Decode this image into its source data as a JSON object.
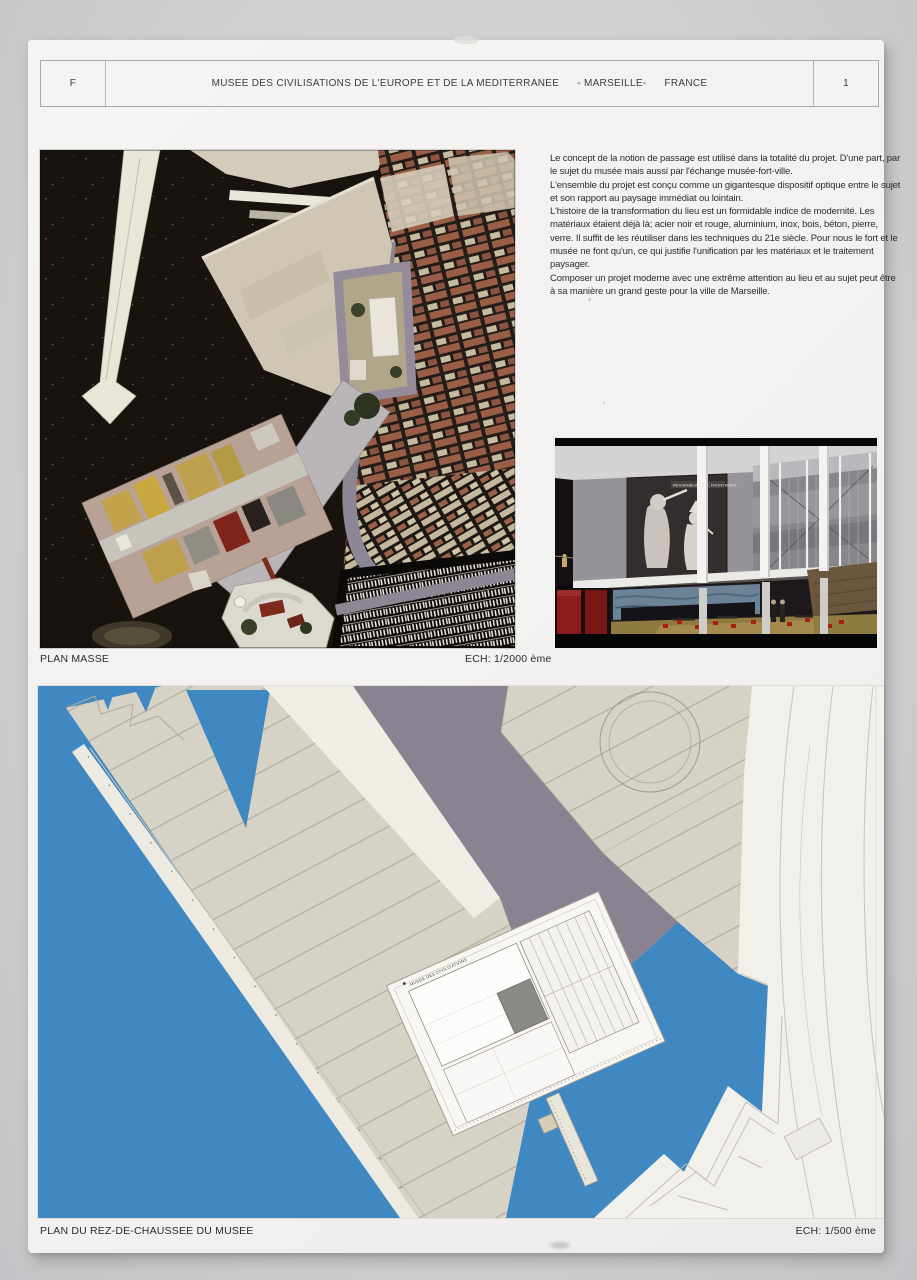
{
  "header": {
    "country_code": "F",
    "title_main": "MUSEE DES CIVILISATIONS DE L'EUROPE ET DE LA MEDITERRANEE",
    "title_city": "- MARSEILLE-",
    "title_country": "FRANCE",
    "page_number": "1"
  },
  "intro_text": {
    "paragraphs": [
      "Le concept de la notion de passage est utilisé dans la totalité du projet. D'une part, par le sujet du musée mais aussi par l'échange musée-fort-ville.",
      "L'ensemble du projet est conçu comme un gigantesque dispositif optique entre le sujet et son rapport au paysage immédiat ou lointain.",
      "L'histoire de la transformation du lieu est un formidable indice de modernité. Les matériaux étaient déjà là; acier noir et rouge, aluminium, inox, bois, béton, pierre, verre. Il suffit de les réutiliser dans les techniques du 21e siècle. Pour nous le fort et le musée ne font qu'un, ce qui justifie l'unification par les matériaux et le traitement paysager.",
      "Composer un projet moderne avec une extrême attention au lieu et au sujet peut être à sa manière un grand geste pour la ville de Marseille."
    ]
  },
  "figures": {
    "plan_masse": {
      "label": "PLAN MASSE",
      "scale": "ECH: 1/2000 ème"
    },
    "ground_floor": {
      "label": "PLAN DU REZ-DE-CHAUSSEE DU MUSEE",
      "scale": "ECH: 1/500 ème"
    },
    "interior_render": {
      "mural_caption": "RESSEMBLANCES, FRONTIERES"
    },
    "site_plan": {
      "building_label": "MUSEE DES CIVILISATIONS"
    }
  },
  "colors": {
    "backdrop_gray": "#d0d0d2",
    "poster_white": "#f3f2f0",
    "aerial_water": "#191310",
    "plan_water_blue": "#3f88c2",
    "pier_beige": "#d6d2c5",
    "band_purple": "#8a8290",
    "city_rust": "#9a5e47",
    "accent_red": "#8c1c1b",
    "accent_gold": "#c2a24b"
  }
}
